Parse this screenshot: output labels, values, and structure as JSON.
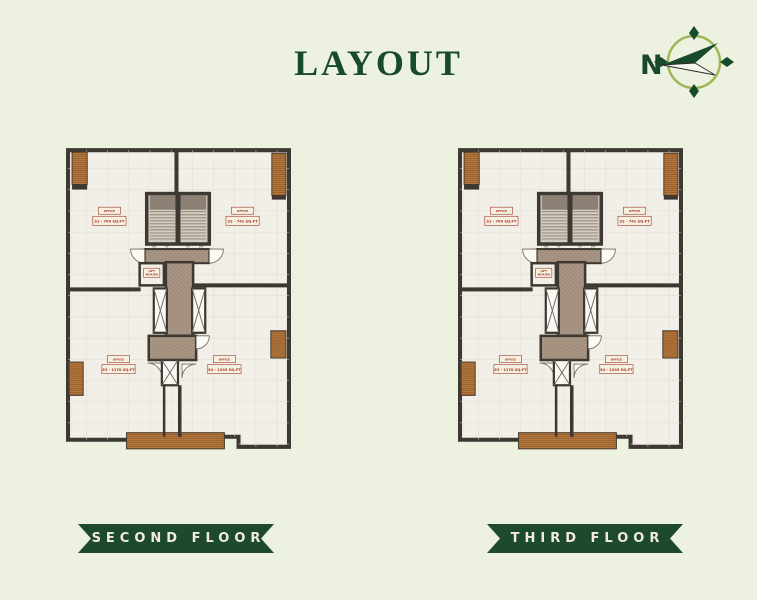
{
  "title": "LAYOUT",
  "compass": {
    "label": "N"
  },
  "floors": [
    {
      "id": "second-floor",
      "banner": "SECOND FLOOR"
    },
    {
      "id": "third-floor",
      "banner": "THIRD FLOOR"
    }
  ],
  "plan": {
    "units": {
      "top_left": {
        "name": "OFFICE",
        "area": "S1 - 709 SQ.FT"
      },
      "top_right": {
        "name": "OFFICE",
        "area": "S2 - 741 SQ.FT"
      },
      "bottom_left": {
        "name": "OFFICE",
        "area": "S3 - 1170 SQ.FT"
      },
      "bottom_right": {
        "name": "OFFICE",
        "area": "S4 - 1293 SQ.FT"
      }
    },
    "core": {
      "lift_room_line1": "LIFT",
      "lift_room_line2": "MCH.RM",
      "stair_marks": [
        "DN",
        "UP",
        "UP",
        "DN"
      ]
    }
  },
  "colors": {
    "background": "#edf2e0",
    "accent_green": "#17492b",
    "banner_green": "#1d4a2e",
    "banner_text": "#f2ecd9",
    "wall": "#3d3832",
    "floor": "#f2efe8",
    "wood": "#b5793f",
    "corridor": "#a89583",
    "label_red": "#a8352b"
  }
}
